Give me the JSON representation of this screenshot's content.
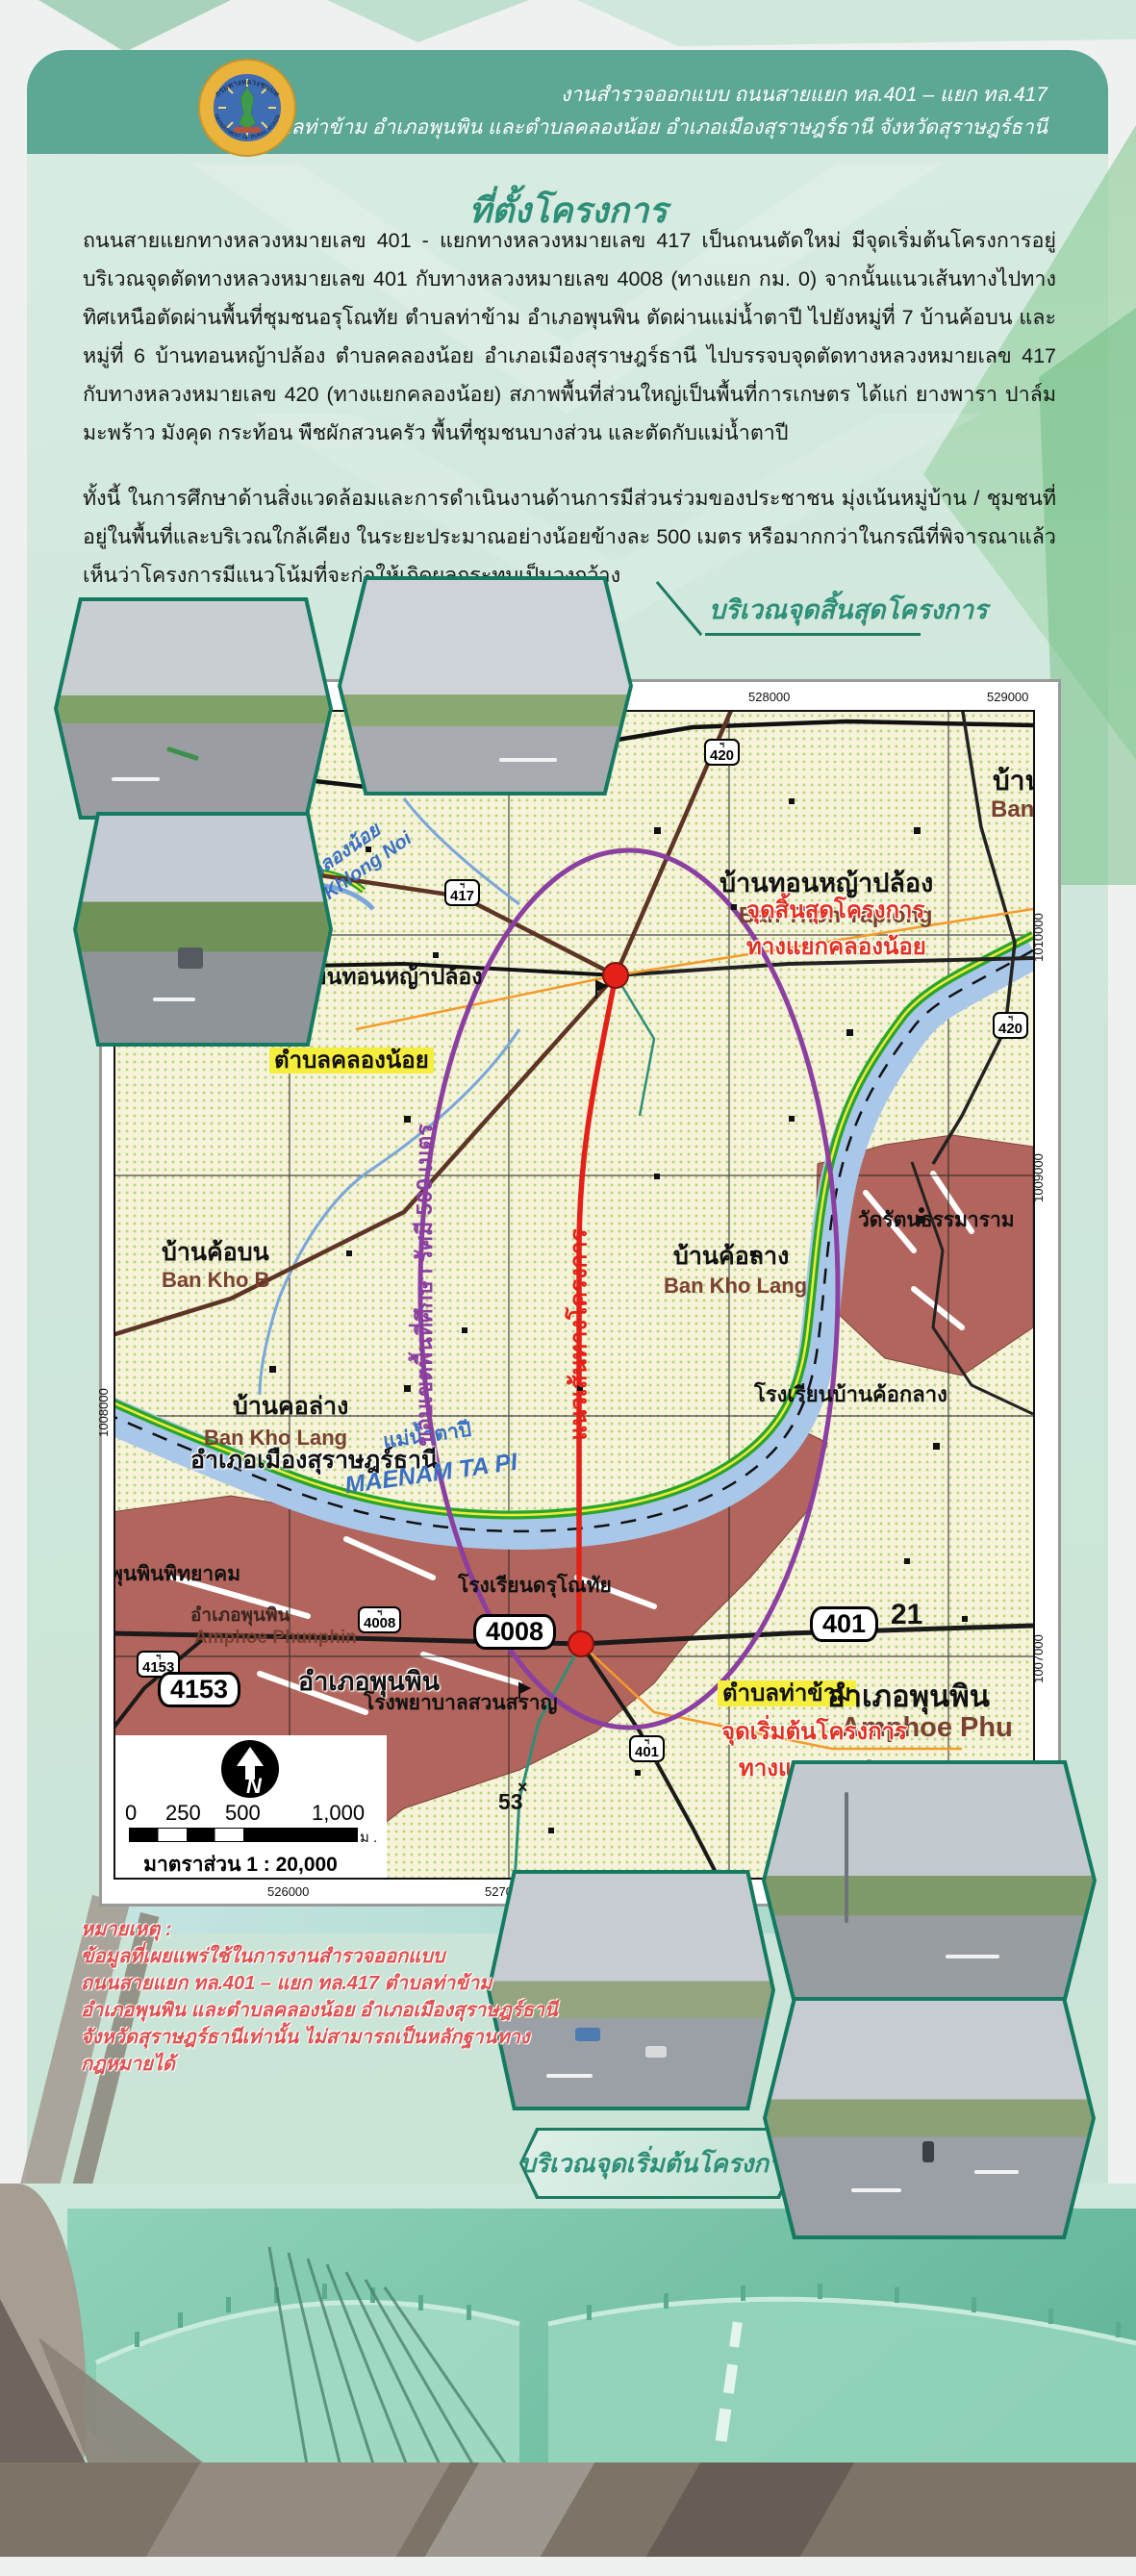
{
  "header": {
    "line1": "งานสำรวจออกแบบ ถนนสายแยก ทล.401 – แยก ทล.417",
    "line2": "ตำบลท่าข้าม อำเภอพุนพิน และตำบลคลองน้อย อำเภอเมืองสุราษฎร์ธานี จังหวัดสุราษฎร์ธานี",
    "logo_ring_top": "กรมทางหลวงชนบท",
    "logo_ring_bottom": "DEPARTMENT OF RURAL ROADS"
  },
  "title": "ที่ตั้งโครงการ",
  "paragraph1": "ถนนสายแยกทางหลวงหมายเลข 401 - แยกทางหลวงหมายเลข 417 เป็นถนนตัดใหม่ มีจุดเริ่มต้นโครงการอยู่บริเวณจุดตัดทางหลวงหมายเลข 401 กับทางหลวงหมายเลข 4008 (ทางแยก กม. 0) จากนั้นแนวเส้นทางไปทางทิศเหนือตัดผ่านพื้นที่ชุมชนอรุโณทัย ตำบลท่าข้าม อำเภอพุนพิน ตัดผ่านแม่น้ำตาปี ไปยังหมู่ที่ 7 บ้านค้อบน และหมู่ที่ 6 บ้านทอนหญ้าปล้อง ตำบลคลองน้อย อำเภอเมืองสุราษฎร์ธานี ไปบรรจบจุดตัดทางหลวงหมายเลข 417 กับทางหลวงหมายเลข 420 (ทางแยกคลองน้อย) สภาพพื้นที่ส่วนใหญ่เป็นพื้นที่การเกษตร ได้แก่ ยางพารา ปาล์ม มะพร้าว มังคุด กระท้อน พืชผักสวนครัว พื้นที่ชุมชนบางส่วน และตัดกับแม่น้ำตาปี",
  "paragraph2": "ทั้งนี้ ในการศึกษาด้านสิ่งแวดล้อมและการดำเนินงานด้านการมีส่วนร่วมของประชาชน มุ่งเน้นหมู่บ้าน / ชุมชนที่อยู่ในพื้นที่และบริเวณใกล้เคียง ในระยะประมาณอย่างน้อยข้างละ 500 เมตร หรือมากกว่าในกรณีที่พิจารณาแล้วเห็นว่าโครงการมีแนวโน้มที่จะก่อให้เกิดผลกระทบเป็นวงกว้าง",
  "callouts": {
    "end_area": "บริเวณจุดสิ้นสุดโครงการ",
    "start_area": "บริเวณจุดเริ่มต้นโครงการ"
  },
  "map": {
    "coords": {
      "t1": "528000",
      "t2": "529000",
      "b1": "526000",
      "b2": "527000",
      "r1": "1010000",
      "r2": "1009000",
      "r3": "1007000",
      "l1": "1008000"
    },
    "shields": {
      "s420": "420",
      "s417": "417",
      "s4008": "4008",
      "s4153": "4153",
      "s401": "401",
      "crown": "ฯ"
    },
    "boxes": {
      "b4008": "4008",
      "b4153": "4153",
      "b401": "401",
      "b421": "21"
    },
    "red": {
      "end1": "จุดสิ้นสุดโครงการ",
      "end2": "ทางแยกคลองน้อย",
      "start1": "จุดเริ่มต้นโครงการ",
      "start2": "ทางแยก กม.0",
      "align": "แนวเส้นทางโครงการ"
    },
    "purple": "ขอบเขตพื้นที่ศึกษา รัศมี 500 เมตร",
    "areas": {
      "khlong_noi": "ตำบลคลองน้อย",
      "tha_kham": "ตำบลท่าข้าม"
    },
    "places": {
      "ban_bang": "บ้านบาง",
      "ban_bang_en": "Ban Bang",
      "thon_yaplong": "บ้านทอนหญ้าปล้อง",
      "thon_yaplong_en": "Ban Thon Yaplong",
      "school_thon": "โรงเรียนทอนหญ้าปล้อง",
      "khlong_noi": "คลองน้อย",
      "khlong_noi_en": "Khlong Noi",
      "kho_bon": "บ้านค้อบน",
      "kho_bon_en": "Ban Kho B",
      "kho_lang": "บ้านค้อลาง",
      "kho_lang_en": "Ban Kho Lang",
      "wat": "วัดรัตนธรรมาราม",
      "school_kho_klang": "โรงเรียนบ้านค้อกลาง",
      "kho_lang2": "บ้านคอล่าง",
      "kho_lang2_en": "Ban Kho Lang",
      "amphoe_mueang": "อำเภอเมืองสุราษฎร์ธานี",
      "tapi": "แม่น้ำตาปี",
      "tapi_en": "MAENAM TA PI",
      "phunphin_school": "พุนพินพิทยาคม",
      "phunphin_s": "อำเภอพุนพิน",
      "phunphin_s_en": "Amphoe Phunphin",
      "phunphin_big": "อำเภอพุนพิน",
      "darunothai": "โรงเรียนดรุโณทัย",
      "hospital": "โรงพยาบาลสวนสราญ",
      "phunphin2": "อำเภอพุนพิน",
      "phunphin2_en": "Amphoe Phu",
      "spot53": "53",
      "spot53_mark": "×"
    },
    "scale": {
      "n": "N",
      "t0": "0",
      "t250": "250",
      "t500": "500",
      "t1000": "1,000",
      "unit": "ม .",
      "caption": "มาตราส่วน 1 : 20,000"
    }
  },
  "note": {
    "title": "หมายเหตุ :",
    "lines": [
      "ข้อมูลที่เผยแพร่ใช้ในการงานสำรวจออกแบบ",
      "ถนนสายแยก ทล.401 – แยก ทล.417 ตำบลท่าข้าม",
      "อำเภอพุนพิน และตำบลคลองน้อย อำเภอเมืองสุราษฎร์ธานี",
      "จังหวัดสุราษฎร์ธานีเท่านั้น ไม่สามารถเป็นหลักฐานทางกฎหมายได้"
    ]
  }
}
